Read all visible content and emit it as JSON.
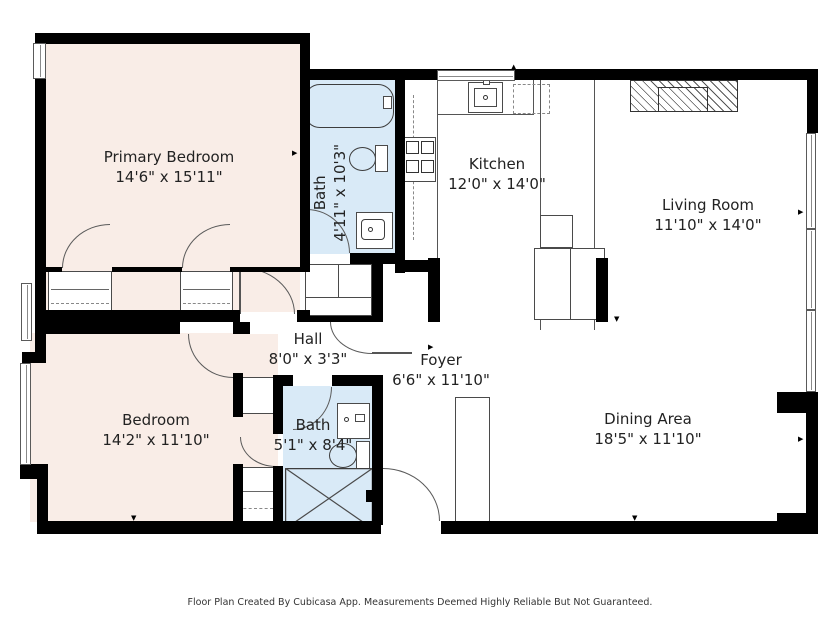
{
  "colors": {
    "wall": "#000000",
    "bedroom": "#f9ede7",
    "bath": "#d9eaf7",
    "text": "#222222"
  },
  "rooms": {
    "primary_bedroom": {
      "name": "Primary Bedroom",
      "dims": "14'6\" x 15'11\""
    },
    "bath_top": {
      "name": "Bath",
      "dims": "4'11\" x 10'3\""
    },
    "kitchen": {
      "name": "Kitchen",
      "dims": "12'0\" x 14'0\""
    },
    "living_room": {
      "name": "Living Room",
      "dims": "11'10\" x 14'0\""
    },
    "hall": {
      "name": "Hall",
      "dims": "8'0\" x 3'3\""
    },
    "foyer": {
      "name": "Foyer",
      "dims": "6'6\" x 11'10\""
    },
    "bedroom": {
      "name": "Bedroom",
      "dims": "14'2\" x 11'10\""
    },
    "bath_bottom": {
      "name": "Bath",
      "dims": "5'1\" x 8'4\""
    },
    "dining_area": {
      "name": "Dining Area",
      "dims": "18'5\" x 11'10\""
    }
  },
  "footer": {
    "text": "Floor Plan Created By Cubicasa App. Measurements Deemed Highly Reliable But Not Guaranteed."
  }
}
